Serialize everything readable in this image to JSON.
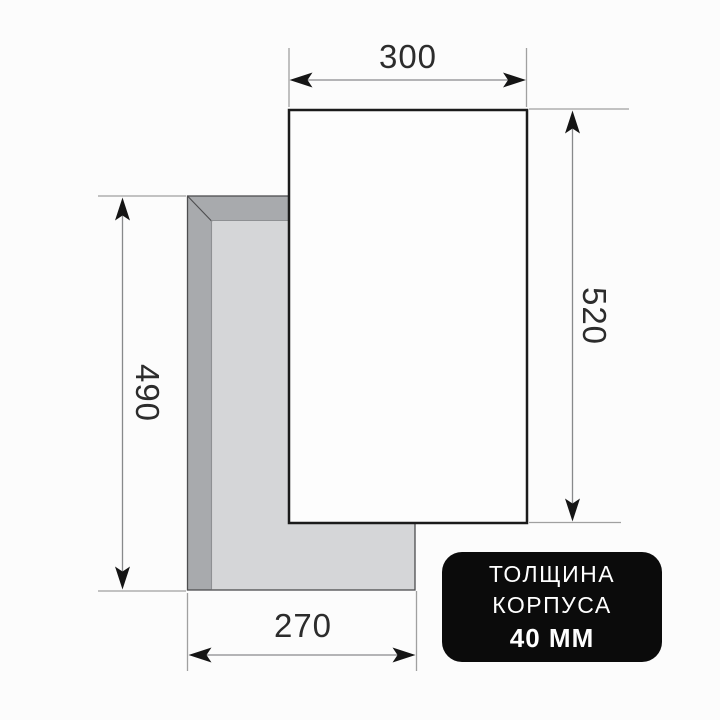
{
  "diagram": {
    "title_semantic": "appliance-dimension-drawing",
    "dimensions": {
      "top_width": "300",
      "right_height": "520",
      "left_height": "490",
      "bottom_width": "270"
    },
    "badge": {
      "line1": "ТОЛЩИНА",
      "line2": "КОРПУСА",
      "line3": "40 ММ"
    },
    "colors": {
      "background": "#fcfcfc",
      "body_edge_dark": "#a8aaad",
      "body_face_light": "#d5d6d8",
      "body_outline": "#4d4d4f",
      "panel_fill": "#fdfdfd",
      "panel_border": "#1b1b1b",
      "extension_line": "#a0a0a0",
      "dimension_line": "#88898b",
      "arrow": "#151515",
      "dim_text": "#2c2c2c",
      "badge_bg": "#0b0b0b",
      "badge_text": "#ffffff"
    }
  }
}
